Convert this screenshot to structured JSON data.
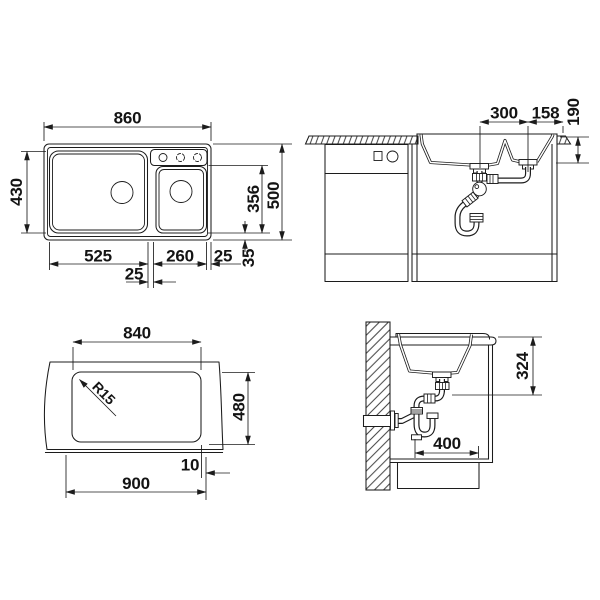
{
  "colors": {
    "line": "#1c1c1c",
    "text": "#141414",
    "background": "#ffffff"
  },
  "views": {
    "top": {
      "dims": {
        "overall_width": "860",
        "main_bowl_depth": "430",
        "main_bowl_width": "525",
        "divider_width": "25",
        "small_bowl_width": "260",
        "right_edge": "25",
        "bottom_edge": "35",
        "small_bowl_length": "356",
        "overall_depth": "500"
      }
    },
    "front": {
      "dims": {
        "drain_spacing": "300",
        "drain_to_edge": "158",
        "bowl_depth": "190"
      }
    },
    "cutout": {
      "dims": {
        "cutout_width": "840",
        "corner_radius": "R15",
        "cutout_depth": "480",
        "edge_offset": "10",
        "outer_width": "900"
      }
    },
    "side": {
      "dims": {
        "outlet_height": "324",
        "base_clearance": "400"
      }
    }
  }
}
